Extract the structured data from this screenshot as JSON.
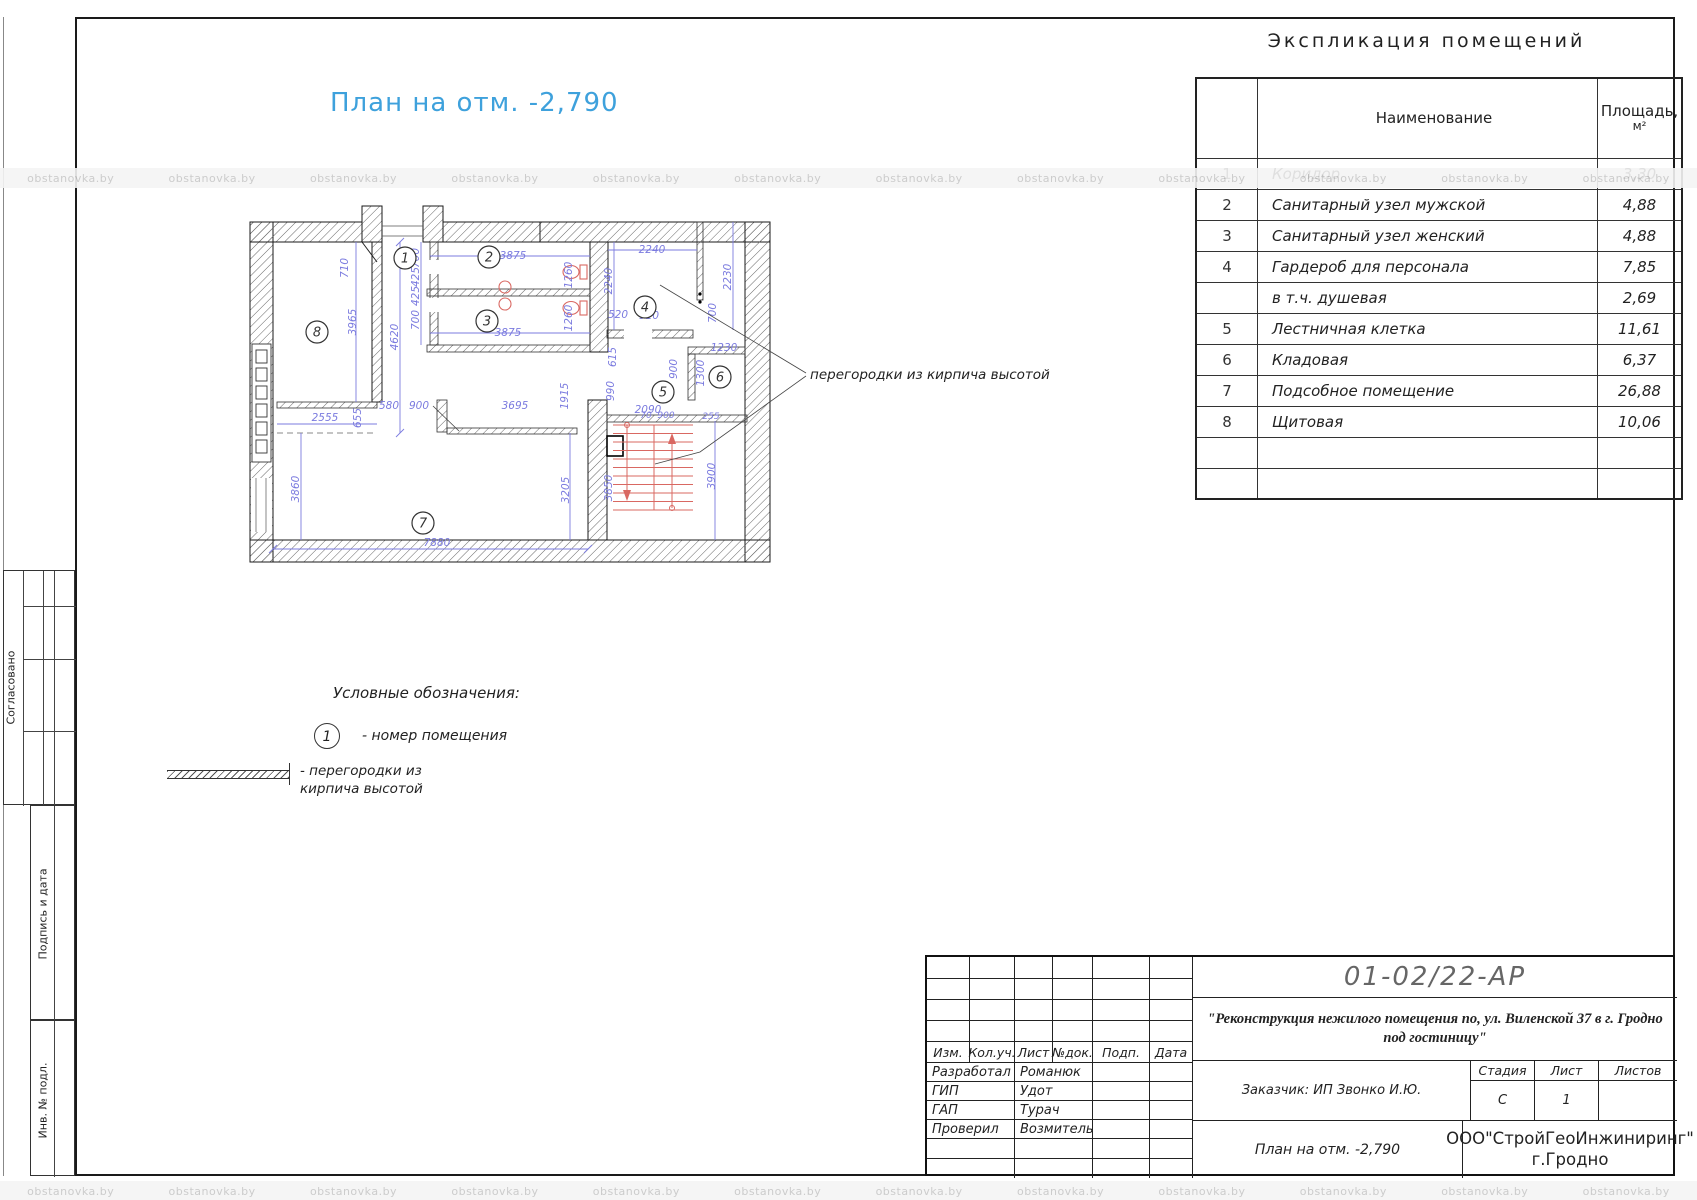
{
  "watermark": "obstanovka.by",
  "heading": "Экспликация помещений",
  "plan_title": "План на отм. -2,790",
  "explication": {
    "col_name": "Наименование",
    "col_area_1": "Площадь,",
    "col_area_2": "м²",
    "rows": [
      {
        "num": "1",
        "name": "Коридор",
        "area": "3,30"
      },
      {
        "num": "2",
        "name": "Санитарный узел мужской",
        "area": "4,88"
      },
      {
        "num": "3",
        "name": "Санитарный узел женский",
        "area": "4,88"
      },
      {
        "num": "4",
        "name": "Гардероб для персонала",
        "area": "7,85"
      },
      {
        "num": "",
        "name": "в т.ч. душевая",
        "area": "2,69"
      },
      {
        "num": "5",
        "name": "Лестничная клетка",
        "area": "11,61"
      },
      {
        "num": "6",
        "name": "Кладовая",
        "area": "6,37"
      },
      {
        "num": "7",
        "name": "Подсобное помещение",
        "area": "26,88"
      },
      {
        "num": "8",
        "name": "Щитовая",
        "area": "10,06"
      }
    ]
  },
  "plan": {
    "annotation": "перегородки из кирпича  высотой",
    "rooms": [
      "1",
      "2",
      "3",
      "4",
      "5",
      "6",
      "7",
      "8"
    ],
    "dims": [
      "710",
      "3965",
      "4620",
      "3875",
      "3875",
      "700",
      "425",
      "425",
      "700",
      "1260",
      "1260",
      "2240",
      "2240",
      "2230",
      "520",
      "910",
      "700",
      "615",
      "990",
      "1915",
      "900",
      "1300",
      "1230",
      "2090",
      "2555",
      "655",
      "580",
      "900",
      "3695",
      "3860",
      "3205",
      "3850",
      "3900",
      "7880",
      "70",
      "900",
      "255"
    ]
  },
  "legend": {
    "title": "Условные обозначения:",
    "item1_symbol": "1",
    "item1_text": "-  номер помещения",
    "item2_text": "-  перегородки из кирпича высотой"
  },
  "titleblock": {
    "code": "01-02/22-АР",
    "project": "\"Реконструкция нежилого помещения по, ул. Виленской  37  в г. Гродно под гостиницу\"",
    "client": "Заказчик: ИП Звонко И.Ю.",
    "sheet_title": "План на отм. -2,790",
    "company_1": "ООО\"СтройГеоИнжиниринг\"",
    "company_2": "г.Гродно",
    "cols": {
      "izm": "Изм.",
      "kol": "Кол.уч.",
      "list": "Лист",
      "doc": "№док.",
      "podp": "Подп.",
      "data": "Дата"
    },
    "stage_head": {
      "stadia": "Стадия",
      "list": "Лист",
      "listov": "Листов"
    },
    "stage_val": {
      "stadia": "С",
      "list": "1",
      "listov": ""
    },
    "roles": [
      {
        "role": "Разработал",
        "name": "Романюк"
      },
      {
        "role": "ГИП",
        "name": "Удот"
      },
      {
        "role": "ГАП",
        "name": "Турач"
      },
      {
        "role": "Проверил",
        "name": "Возмитель"
      }
    ]
  },
  "margins": {
    "soglasovano": "Согласовано",
    "podpis": "Подпись и дата",
    "inv": "Инв. № подл."
  },
  "colors": {
    "accent_blue": "#3ea1dc",
    "dim_purple": "#7b7bdf",
    "red": "#d96862"
  }
}
